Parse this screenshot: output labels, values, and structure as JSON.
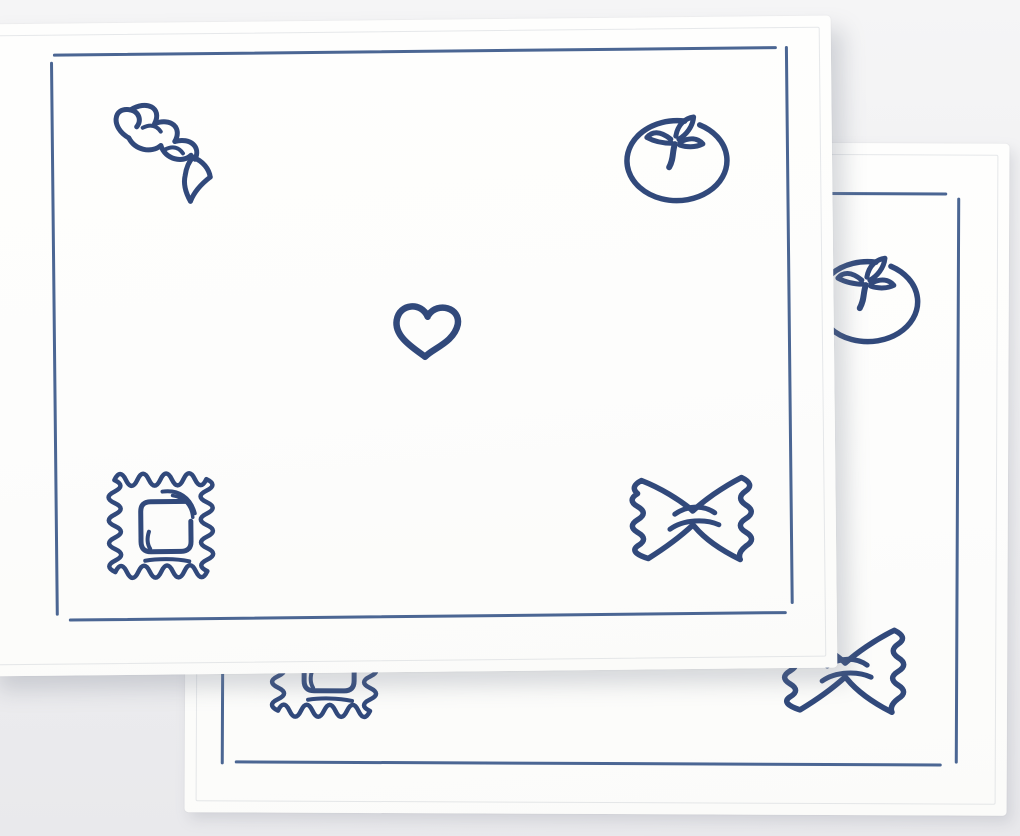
{
  "scene": {
    "description": "Product photo of two overlapping white fabric placemats, each finished with a hand-stitched blue border frame and embroidered blue pasta motifs: fusilli, tomato, heart, ravioli and farfalle",
    "colors": {
      "background_top": "#f5f5f6",
      "background_bottom": "#e9e9ec",
      "fabric": "#fdfdfc",
      "stitch_border": "#44608f",
      "embroidery": "#31497b"
    }
  },
  "placemats": [
    {
      "id": "front-placemat",
      "motifs": [
        "fusilli",
        "tomato",
        "heart",
        "ravioli",
        "farfalle"
      ]
    },
    {
      "id": "back-placemat",
      "motifs": [
        "tomato",
        "ravioli",
        "farfalle"
      ]
    }
  ]
}
